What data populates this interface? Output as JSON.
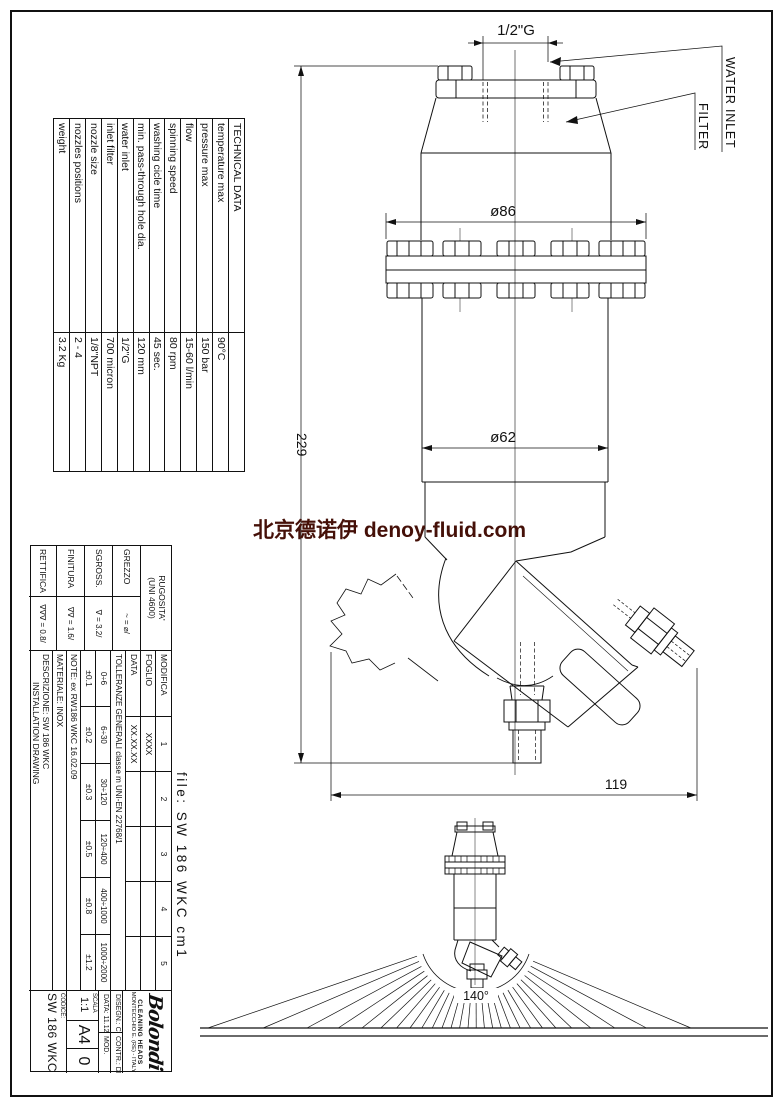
{
  "watermark": {
    "text": "北京德诺伊 denoy-fluid.com",
    "color": "#451008"
  },
  "file_label": "file: SW 186 WKC cm1",
  "labels": {
    "water_inlet": "WATER INLET",
    "filter": "FILTER"
  },
  "dimensions": {
    "inlet": "1/2\"G",
    "flange_dia": "ø86",
    "body_dia": "ø62",
    "height": "229",
    "offset": "119",
    "spray_angle": "140°"
  },
  "technical_table": {
    "title": "TECHNICAL DATA",
    "rows": [
      {
        "label": "temperature max",
        "value": "90°C"
      },
      {
        "label": "pressure max",
        "value": "150 bar"
      },
      {
        "label": "flow",
        "value": "15-60 l/min"
      },
      {
        "label": "spinning speed",
        "value": "80 rpm"
      },
      {
        "label": "washing cicle time",
        "value": "45 sec."
      },
      {
        "label": "min. pass-through hole dia.",
        "value": "120 mm"
      },
      {
        "label": "water inlet",
        "value": "1/2\"G"
      },
      {
        "label": "inlet filter",
        "value": "700 micron"
      },
      {
        "label": "nozzle size",
        "value": "1/8\"NPT"
      },
      {
        "label": "nozzles positions",
        "value": "2 - 4"
      },
      {
        "label": "weight",
        "value": "3.2 Kg"
      }
    ]
  },
  "title_block": {
    "roughness": {
      "header1": "RUGOSITA'",
      "header2": "(UNI 4600)",
      "rows": [
        {
          "label": "GREZZO",
          "symbol": "~  =  ⌀/"
        },
        {
          "label": "SGROSS.",
          "symbol": "∇  =  3.2/"
        },
        {
          "label": "FINITURA",
          "symbol": "∇∇  =  1.6/"
        },
        {
          "label": "RETTIFICA",
          "symbol": "∇∇∇  =  0.8/"
        }
      ]
    },
    "modifica": {
      "label": "MODIFICA",
      "cols": [
        "1",
        "2",
        "3",
        "4",
        "5"
      ]
    },
    "foglio": {
      "label": "FOGLIO",
      "value": "XXXX"
    },
    "data_row": {
      "label": "DATA",
      "value": "XX.XX.XX"
    },
    "tolerances": {
      "header": "TOLLERANZE GENERALI   classe m   UNI-EN 22768/1",
      "ranges": [
        "0÷6",
        "6÷30",
        "30÷120",
        "120÷400",
        "400÷1000",
        "1000÷2000"
      ],
      "values": [
        "±0.1",
        "±0.2",
        "±0.3",
        "±0.5",
        "±0.8",
        "±1.2"
      ]
    },
    "note": "NOTE:  ex RW186 WKC 16.02.09",
    "materiale": "MATERIALE:  INOX",
    "descrizione_line1": "DESCRIZIONE: SW 186 WKC",
    "descrizione_line2": "INSTALLATION DRAWING",
    "logo": {
      "brand": "Bolondi",
      "tagline": "CLEANING HEADS",
      "address": "MONTECCHIO E. (RE) - ITALY"
    },
    "disegn": "DISEGN.:  CR",
    "contr": "CONTR.:  DM",
    "data2": "DATA:  11.12.09",
    "mod": "MOD.",
    "scala_label": "SCALA",
    "scala_value": "1:1",
    "format": "A4",
    "revision": "0",
    "codice_label": "CODICE:",
    "codice_value": "SW 186 WKC"
  }
}
